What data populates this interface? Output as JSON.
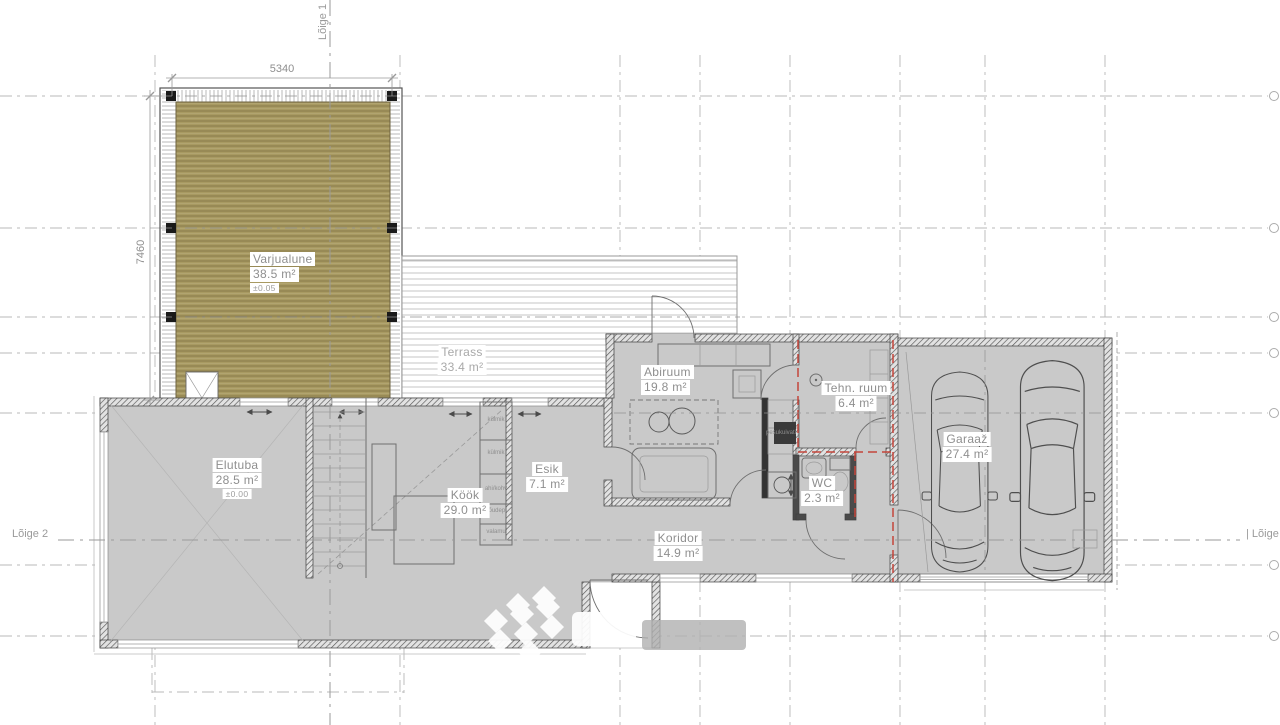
{
  "sections": {
    "top": "Lõige 1",
    "left": "Lõige 2",
    "right": "| Lõige 2"
  },
  "dims": {
    "width": "5340",
    "height": "7460"
  },
  "rooms": {
    "varjualune": {
      "name": "Varjualune",
      "area": "38.5 m²",
      "level": "±0.05"
    },
    "terrass": {
      "name": "Terrass",
      "area": "33.4 m²"
    },
    "elutuba": {
      "name": "Elutuba",
      "area": "28.5 m²",
      "level": "±0.00"
    },
    "kook": {
      "name": "Köök",
      "area": "29.0 m²"
    },
    "esik": {
      "name": "Esik",
      "area": "7.1 m²"
    },
    "abiruum": {
      "name": "Abiruum",
      "area": "19.8 m²"
    },
    "koridor": {
      "name": "Koridor",
      "area": "14.9 m²"
    },
    "wc": {
      "name": "WC",
      "area": "2.3 m²"
    },
    "tehn": {
      "name": "Tehn. ruum",
      "area": "6.4 m²"
    },
    "garaaz": {
      "name": "Garaaž",
      "area": "27.4 m²"
    }
  },
  "kitchen": {
    "appliances": [
      "külmik",
      "külmik",
      "ahi/kohv",
      "nõudep.",
      "valamu"
    ]
  },
  "laundry": {
    "label": "pesukuivati"
  },
  "colors": {
    "wood": "#a89a62",
    "floor": "#c9c9c9",
    "fire_line": "#c4453a",
    "grid": "#b8b8b8"
  }
}
